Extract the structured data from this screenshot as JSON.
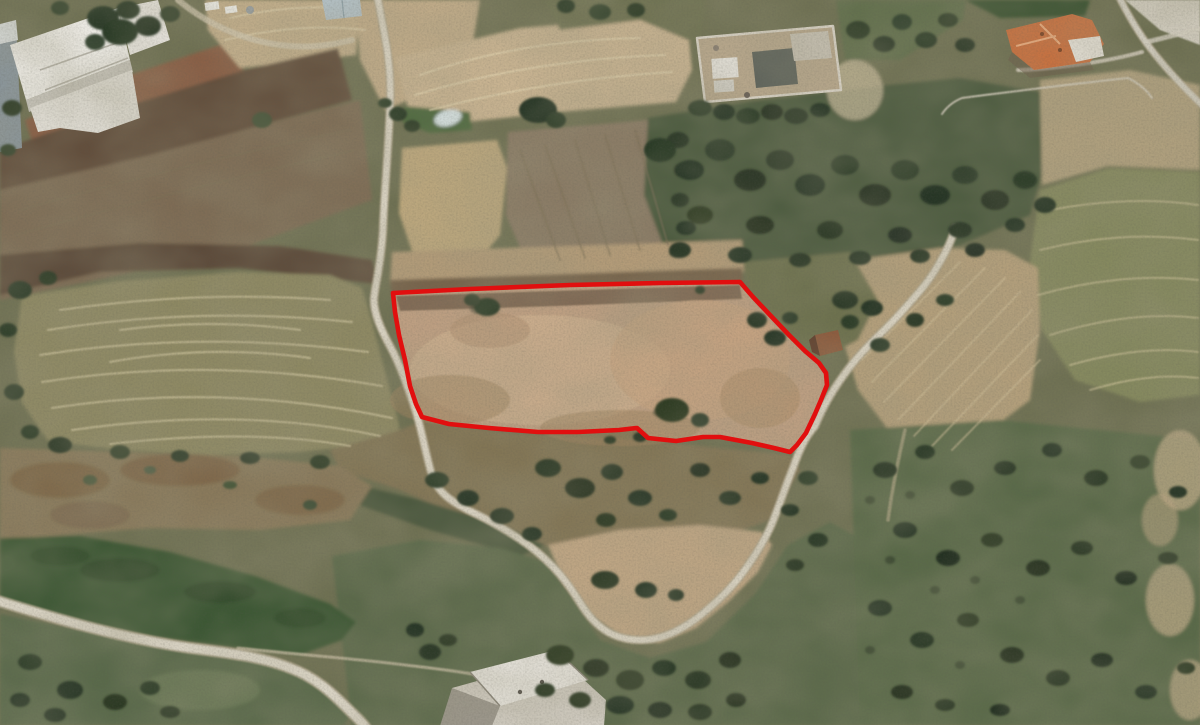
{
  "scene": {
    "type": "aerial-satellite-photo",
    "description": "Satellite aerial photograph of rural farmland and scrubland with dirt roads, ploughed fields, olive groves, scattered buildings, and one land parcel outlined in red",
    "visible_features": [
      "white warehouse buildings top-left",
      "blue-roofed shed",
      "terraced and ploughed fields",
      "contour-striped hay fields",
      "walled compound",
      "olive grove",
      "orange-roofed house top-right",
      "small shed at parcel edge",
      "pond",
      "dirt roads with hairpin turnaround",
      "white building bottom-center",
      "red parcel boundary overlay"
    ]
  },
  "parcel": {
    "name": "highlighted-land-parcel",
    "outline_color": "#e10f0f",
    "outline_width": "4.6",
    "points": "393,293 470,289 570,285 660,283 740,282 753,297 770,315 789,335 805,351 819,363 826,373 827,385 821,400 815,414 806,433 797,445 790,452 774,448 752,443 720,437 703,437 676,441 648,438 637,428 619,430 578,432 538,432 489,428 449,424 422,417 416,404 410,386 405,360 399,335 395,312"
  }
}
